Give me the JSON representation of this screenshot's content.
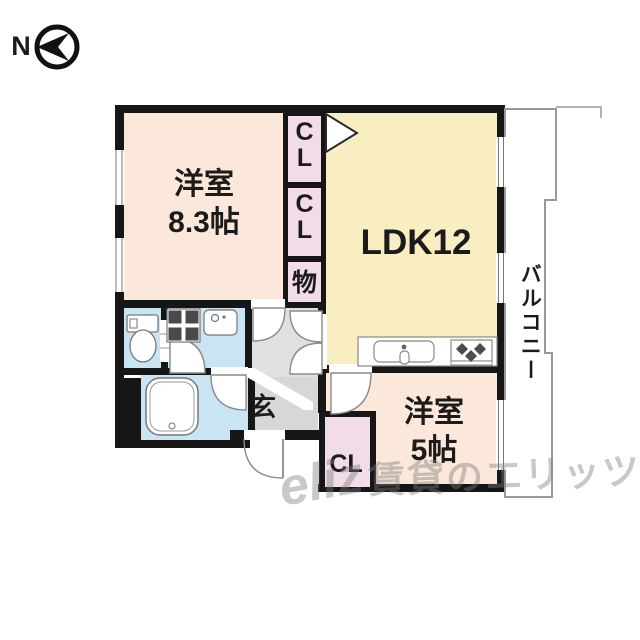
{
  "compass": {
    "north_label": "N"
  },
  "floor_plan": {
    "room_west_large": {
      "name": "洋室",
      "size": "8.3帖"
    },
    "ldk": {
      "label": "LDK12"
    },
    "room_west_small": {
      "name": "洋室",
      "size": "5帖"
    },
    "balcony": {
      "label": "バルコニー"
    },
    "entrance": {
      "label": "玄"
    },
    "closet_upper": {
      "label": "CL"
    },
    "closet_middle": {
      "label": "CL"
    },
    "storage": {
      "label": "物"
    },
    "closet_small_room": {
      "label": "CL"
    }
  },
  "watermark": {
    "logo": "eliz",
    "text": "賃貸のエリッツ"
  },
  "colors": {
    "wall": "#161616",
    "western_room": "#fbe8da",
    "ldk": "#f8eec2",
    "closet": "#f2dcea",
    "wet_area": "#c9e4f3",
    "hall": "#e0e0e0",
    "entrance_floor": "#d7d7d7",
    "balcony_line": "#999999"
  }
}
